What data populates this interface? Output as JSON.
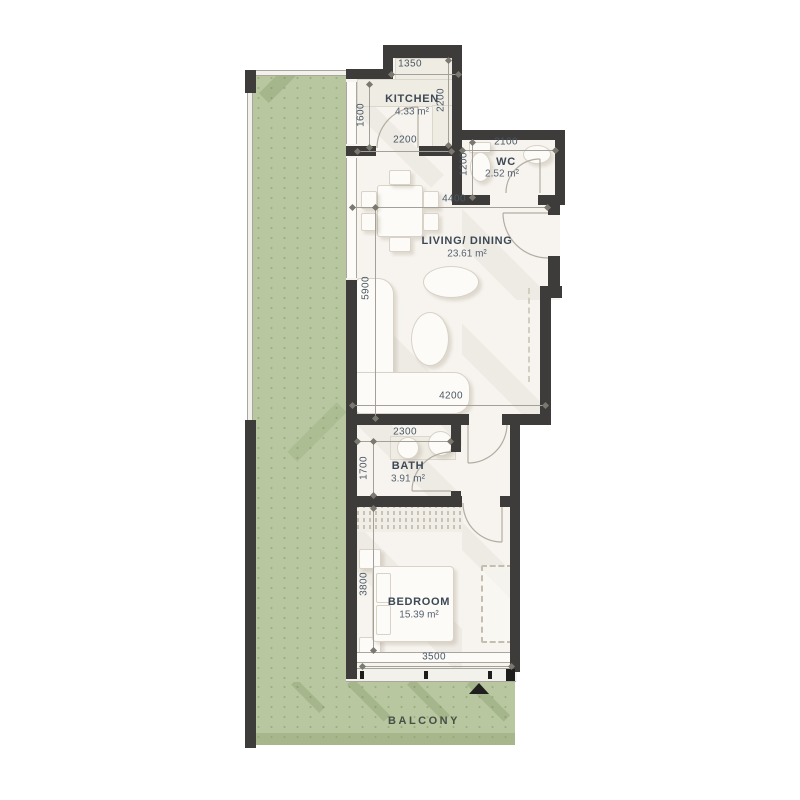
{
  "plan_type": "apartment-floor-plan",
  "rooms": [
    {
      "name": "KITCHEN",
      "area": "4.33 m²"
    },
    {
      "name": "WC",
      "area": "2.52 m²"
    },
    {
      "name": "LIVING/ DINING",
      "area": "23.61 m²"
    },
    {
      "name": "BATH",
      "area": "3.91 m²"
    },
    {
      "name": "BEDROOM",
      "area": "15.39 m²"
    },
    {
      "name": "BALCONY",
      "area": ""
    }
  ],
  "dimensions_mm": {
    "kitchen_top": "1350",
    "kitchen_window": "1600",
    "kitchen_depth": "2200",
    "kitchen_width": "2200",
    "wc_width": "2100",
    "wc_depth": "1200",
    "living_width": "4400",
    "living_depth": "5900",
    "living_bottom": "4200",
    "bath_width": "2300",
    "bath_depth": "1700",
    "bedroom_depth": "3800",
    "bedroom_width": "3500"
  },
  "colors": {
    "wall": "#3d3c3a",
    "floor": "#f7f4ef",
    "balcony_green": "#b8c7a0",
    "dimension_text": "#4a5763",
    "room_text": "#3c4854"
  }
}
